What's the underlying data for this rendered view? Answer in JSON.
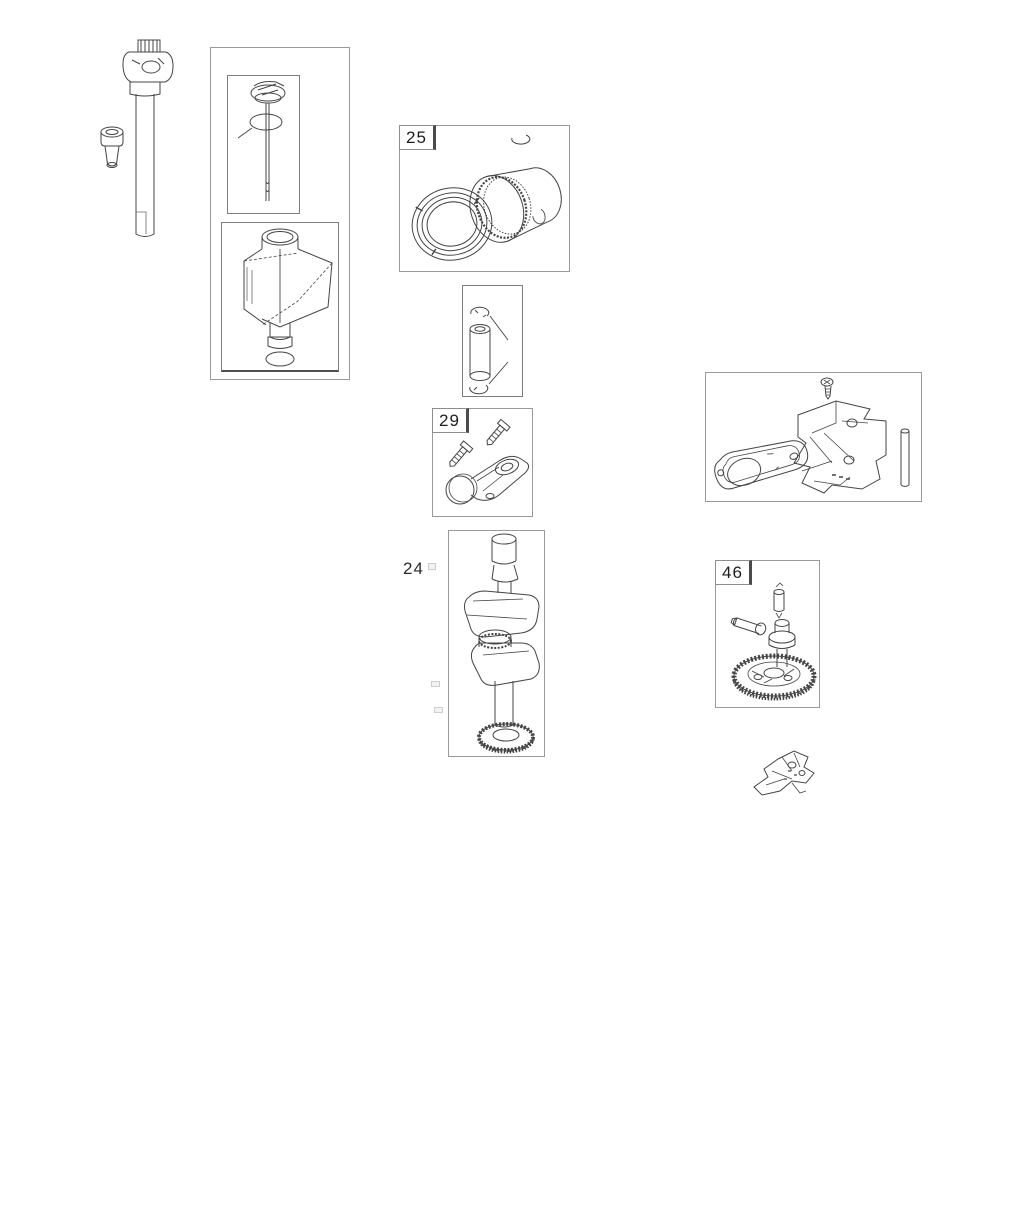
{
  "diagram": {
    "type": "engine-parts-exploded-diagram",
    "callouts": [
      {
        "id": "25",
        "style": "boxed"
      },
      {
        "id": "29",
        "style": "boxed"
      },
      {
        "id": "24",
        "style": "plain"
      },
      {
        "id": "46",
        "style": "boxed"
      }
    ],
    "parts": [
      "oil-fill-cap-and-tube",
      "oil-plug",
      "dipstick",
      "dipstick-o-ring",
      "oil-fill-funnel-bracket",
      "funnel-o-ring",
      "piston",
      "piston-ring-set",
      "pin-retaining-clip",
      "piston-pin",
      "retaining-clips",
      "connecting-rod",
      "rod-bolts",
      "crankshaft",
      "timing-gear",
      "sump-gasket",
      "mounting-bracket",
      "screw",
      "dowel-pin",
      "camshaft-gear-assembly",
      "tappet-plunger",
      "camshaft-bolt",
      "governor-crank"
    ]
  },
  "colors": {
    "background": "#ffffff",
    "line_art": "#454545",
    "box_border": "#9a9a9a",
    "label_text": "#1d1d1d"
  }
}
